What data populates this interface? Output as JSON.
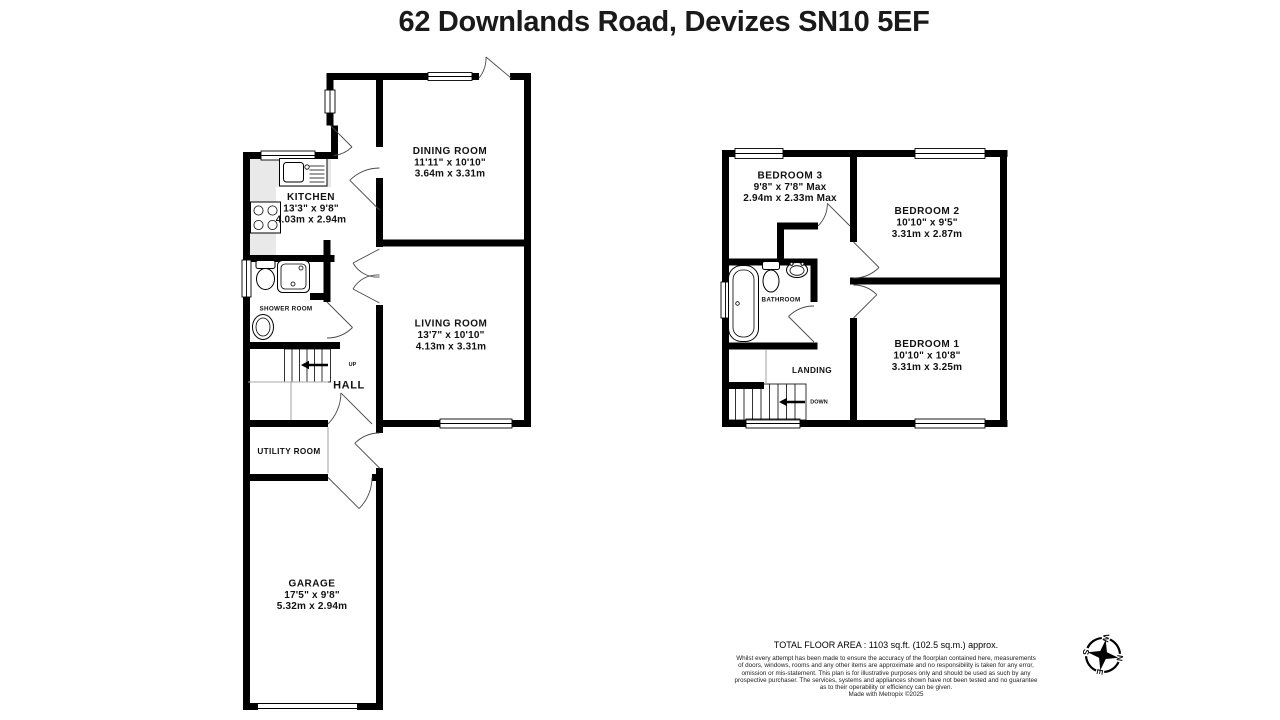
{
  "title": "62 Downlands Road, Devizes SN10 5EF",
  "ground_floor": {
    "rooms": {
      "kitchen": {
        "name": "KITCHEN",
        "imperial": "13'3\" x 9'8\"",
        "metric": "4.03m x 2.94m"
      },
      "dining_room": {
        "name": "DINING ROOM",
        "imperial": "11'11\" x 10'10\"",
        "metric": "3.64m x 3.31m"
      },
      "living_room": {
        "name": "LIVING ROOM",
        "imperial": "13'7\" x 10'10\"",
        "metric": "4.13m x 3.31m"
      },
      "shower_room": {
        "name": "SHOWER ROOM"
      },
      "hall": {
        "name": "HALL"
      },
      "utility_room": {
        "name": "UTILITY ROOM"
      },
      "garage": {
        "name": "GARAGE",
        "imperial": "17'5\" x 9'8\"",
        "metric": "5.32m x 2.94m"
      }
    },
    "stairs_label": "UP"
  },
  "first_floor": {
    "rooms": {
      "bedroom_1": {
        "name": "BEDROOM 1",
        "imperial": "10'10\" x 10'8\"",
        "metric": "3.31m x 3.25m"
      },
      "bedroom_2": {
        "name": "BEDROOM 2",
        "imperial": "10'10\" x 9'5\"",
        "metric": "3.31m x 2.87m"
      },
      "bedroom_3": {
        "name": "BEDROOM 3",
        "imperial": "9'8\" x 7'8\" Max",
        "metric": "2.94m x 2.33m Max"
      },
      "bathroom": {
        "name": "BATHROOM"
      },
      "landing": {
        "name": "LANDING"
      }
    },
    "stairs_label": "DOWN"
  },
  "compass": {
    "n": "N",
    "e": "E",
    "s": "S",
    "w": "W"
  },
  "footer": {
    "total_area": "TOTAL FLOOR AREA : 1103 sq.ft. (102.5 sq.m.) approx.",
    "disclaimer_lines": [
      "Whilst every attempt has been made to ensure the accuracy of the floorplan contained here, measurements",
      "of doors, windows, rooms and any other items are approximate and no responsibility is taken for any error,",
      "omission or mis-statement. This plan is for illustrative purposes only and should be used as such by any",
      "prospective purchaser. The services, systems and appliances shown have not been tested and no guarantee",
      "as to their operability or efficiency can be given.",
      "Made with Metropix ©2025"
    ]
  },
  "colors": {
    "wall": "#000000",
    "counter": "#e9e9e9",
    "thin_line": "#aaaaaa",
    "background": "#ffffff"
  }
}
